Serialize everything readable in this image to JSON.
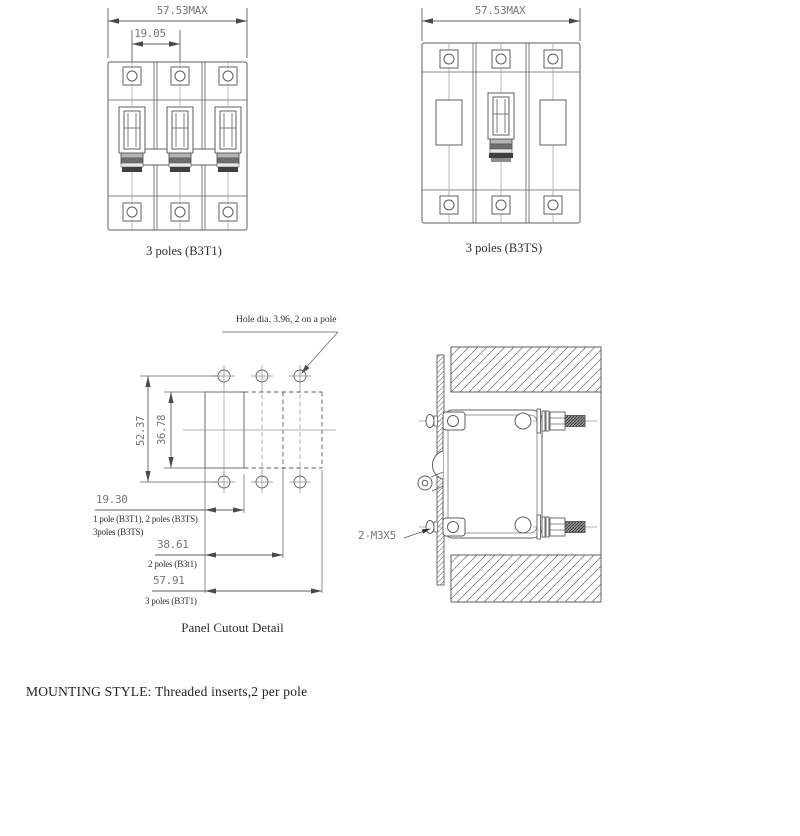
{
  "page": {
    "background": "#ffffff"
  },
  "colors": {
    "line": "#5f5f5f",
    "thin_line": "#8a8a8a",
    "dim_text": "#757575",
    "label_text": "#2e2e2e",
    "arrow": "#4a4a4a"
  },
  "fig_b3t1": {
    "dim_overall": "57.53MAX",
    "dim_pitch": "19.05",
    "caption": "3 poles (B3T1)"
  },
  "fig_b3ts": {
    "dim_overall": "57.53MAX",
    "caption": "3 poles (B3TS)"
  },
  "cutout": {
    "hole_note": "Hole dia. 3.96, 2 on a pole",
    "dim_vertical_outer": "52.37",
    "dim_vertical_inner": "36.78",
    "dim1": {
      "value": "19.30",
      "label1": "1 pole (B3T1), 2 poles (B3TS)",
      "label2": "3poles (B3TS)"
    },
    "dim2": {
      "value": "38.61",
      "label1": "2 poles (B3t1)"
    },
    "dim3": {
      "value": "57.91",
      "label1": "3 poles (B3T1)"
    },
    "caption": "Panel Cutout Detail"
  },
  "side": {
    "screw_note": "2-M3X5"
  },
  "mounting_note": "MOUNTING STYLE: Threaded inserts,2 per pole"
}
